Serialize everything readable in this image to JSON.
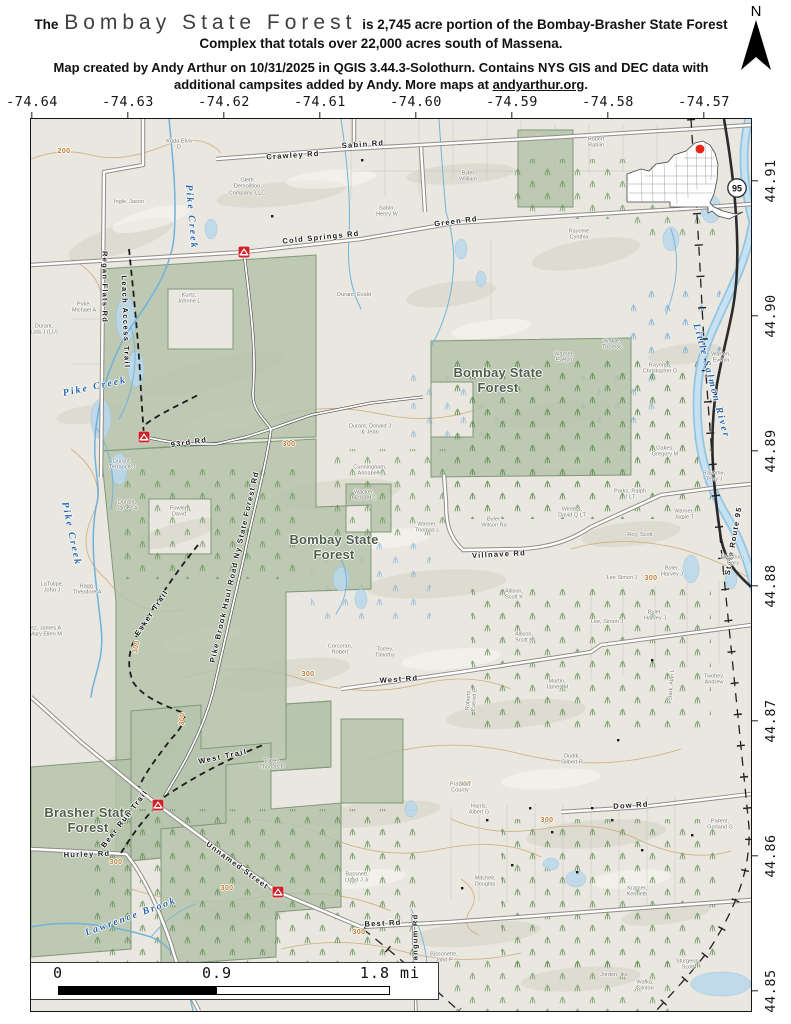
{
  "header": {
    "title_prefix": "The",
    "title_name": "Bombay State Forest",
    "title_rest": "is 2,745 acre portion of the Bombay-Brasher State Forest",
    "title_line2": "Complex that totals over 22,000 acres south of Massena.",
    "credit_line1": "Map created by Andy Arthur on 10/31/2025 in QGIS 3.44.3-Solothurn. Contains NYS GIS and DEC data with",
    "credit_line2_prefix": "additional campsites added by Andy. More maps at ",
    "credit_link": "andyarthur.org",
    "credit_suffix": ".",
    "north_label": "N"
  },
  "axes": {
    "longitudes": [
      "-74.64",
      "-74.63",
      "-74.62",
      "-74.61",
      "-74.60",
      "-74.59",
      "-74.58",
      "-74.57"
    ],
    "latitudes": [
      "44.91",
      "44.90",
      "44.89",
      "44.88",
      "44.87",
      "44.86",
      "44.85"
    ]
  },
  "scalebar": {
    "start": "0",
    "mid": "0.9",
    "end": "1.8 mi"
  },
  "map": {
    "inset": {
      "route_shield": "95"
    },
    "campsites": [
      {
        "x": 213,
        "y": 133
      },
      {
        "x": 113,
        "y": 318
      },
      {
        "x": 127,
        "y": 686
      },
      {
        "x": 247,
        "y": 773
      }
    ],
    "labels": [
      {
        "t": "Bombay State\nForest",
        "x": 467,
        "y": 262,
        "k": "forest"
      },
      {
        "t": "Bombay State\nForest",
        "x": 303,
        "y": 429,
        "k": "forest"
      },
      {
        "t": "Brasher State\nForest",
        "x": 57,
        "y": 702,
        "k": "forest"
      },
      {
        "t": "Pike Creek",
        "x": 160,
        "y": 98,
        "r": 85,
        "k": "water"
      },
      {
        "t": "Pike Creek",
        "x": 40,
        "y": 415,
        "r": 78,
        "k": "water"
      },
      {
        "t": "Pike Creek",
        "x": 64,
        "y": 268,
        "r": -12,
        "k": "water"
      },
      {
        "t": "Lawrence Brook",
        "x": 100,
        "y": 798,
        "r": -20,
        "k": "water"
      },
      {
        "t": "Little Salmon River",
        "x": 680,
        "y": 262,
        "r": 75,
        "k": "water"
      },
      {
        "t": "Crawley Rd",
        "x": 262,
        "y": 37,
        "r": -4,
        "k": "road"
      },
      {
        "t": "Sabin Rd",
        "x": 332,
        "y": 26,
        "r": -4,
        "k": "road"
      },
      {
        "t": "Cold Springs Rd",
        "x": 290,
        "y": 119,
        "r": -6,
        "k": "road"
      },
      {
        "t": "Green Rd",
        "x": 425,
        "y": 103,
        "r": -7,
        "k": "road"
      },
      {
        "t": "Regan Flats Rd",
        "x": 73,
        "y": 168,
        "r": 90,
        "k": "road"
      },
      {
        "t": "93rd Rd",
        "x": 158,
        "y": 324,
        "r": -8,
        "k": "road"
      },
      {
        "t": "Pike Brook Haul Road Ny State Forest Rd",
        "x": 204,
        "y": 448,
        "r": -77,
        "k": "road"
      },
      {
        "t": "Villnave Rd",
        "x": 468,
        "y": 436,
        "r": -3,
        "k": "road"
      },
      {
        "t": "West Rd",
        "x": 368,
        "y": 561,
        "r": -4,
        "k": "road"
      },
      {
        "t": "Hurley Rd",
        "x": 56,
        "y": 736,
        "r": -2,
        "k": "road"
      },
      {
        "t": "Unnamed Street",
        "x": 206,
        "y": 747,
        "r": 36,
        "k": "road"
      },
      {
        "t": "Best Rd",
        "x": 352,
        "y": 805,
        "r": -3,
        "k": "road"
      },
      {
        "t": "Dow Rd",
        "x": 600,
        "y": 687,
        "r": -4,
        "k": "road"
      },
      {
        "t": "Wangum Rd",
        "x": 385,
        "y": 822,
        "r": -90,
        "k": "road"
      },
      {
        "t": "State Route 95",
        "x": 703,
        "y": 422,
        "r": -80,
        "k": "road"
      },
      {
        "t": "Leach Access Trail",
        "x": 94,
        "y": 203,
        "r": 88,
        "k": "trail"
      },
      {
        "t": "Esker Trail",
        "x": 121,
        "y": 494,
        "r": -56,
        "k": "trail"
      },
      {
        "t": "West Trail",
        "x": 192,
        "y": 638,
        "r": -12,
        "k": "trail"
      },
      {
        "t": "Bear Run Trail",
        "x": 94,
        "y": 700,
        "r": -52,
        "k": "trail"
      },
      {
        "t": "200",
        "x": 33,
        "y": 33,
        "k": "contour"
      },
      {
        "t": "300",
        "x": 258,
        "y": 326,
        "k": "contour"
      },
      {
        "t": "300",
        "x": 106,
        "y": 528,
        "r": -80,
        "k": "contour"
      },
      {
        "t": "300",
        "x": 277,
        "y": 556,
        "k": "contour"
      },
      {
        "t": "300",
        "x": 85,
        "y": 744,
        "k": "contour"
      },
      {
        "t": "300",
        "x": 196,
        "y": 770,
        "k": "contour"
      },
      {
        "t": "300",
        "x": 434,
        "y": 666,
        "k": "contour"
      },
      {
        "t": "300",
        "x": 516,
        "y": 702,
        "k": "contour"
      },
      {
        "t": "300",
        "x": 620,
        "y": 460,
        "k": "contour"
      },
      {
        "t": "300",
        "x": 328,
        "y": 814,
        "k": "contour"
      },
      {
        "t": "300",
        "x": 152,
        "y": 600,
        "r": -85,
        "k": "contour"
      },
      {
        "t": "Kuda Elva\nD",
        "x": 148,
        "y": 26,
        "k": "parcel"
      },
      {
        "t": "Gleth\nDemolition\nCompany, LLC",
        "x": 216,
        "y": 68,
        "k": "parcel"
      },
      {
        "t": "Ingle, Jason",
        "x": 98,
        "y": 83,
        "k": "parcel"
      },
      {
        "t": "Byler\nWilliam",
        "x": 437,
        "y": 58,
        "k": "parcel"
      },
      {
        "t": "Robert\nRablin",
        "x": 565,
        "y": 24,
        "k": "parcel"
      },
      {
        "t": "Sabin,\nHenry W",
        "x": 356,
        "y": 93,
        "k": "parcel"
      },
      {
        "t": "Rayome\nCynthia",
        "x": 548,
        "y": 116,
        "k": "parcel"
      },
      {
        "t": "Pyke,\nMichael A",
        "x": 53,
        "y": 189,
        "k": "parcel"
      },
      {
        "t": "Kurtz,\nJohnne L",
        "x": 158,
        "y": 180,
        "k": "parcel"
      },
      {
        "t": "Durant, Evald",
        "x": 323,
        "y": 176,
        "k": "parcel"
      },
      {
        "t": "Durant,\nLida J (LU)",
        "x": 13,
        "y": 211,
        "k": "parcel"
      },
      {
        "t": "Wakle,\nThomas",
        "x": 581,
        "y": 226,
        "k": "parcel"
      },
      {
        "t": "Warren,\nEvelyn",
        "x": 690,
        "y": 239,
        "k": "parcel"
      },
      {
        "t": "Warner,\nEvelyn",
        "x": 533,
        "y": 239,
        "k": "parcel"
      },
      {
        "t": "Rayome,\nChristopher O",
        "x": 629,
        "y": 250,
        "k": "parcel"
      },
      {
        "t": "Durant,\nTerrance J",
        "x": 91,
        "y": 346,
        "k": "parcel"
      },
      {
        "t": "Durant,\nJames A",
        "x": 96,
        "y": 387,
        "k": "parcel"
      },
      {
        "t": "Fowler,\nDavid",
        "x": 148,
        "y": 393,
        "k": "parcel"
      },
      {
        "t": "Durant, Donald J\n& Jean",
        "x": 339,
        "y": 311,
        "k": "parcel"
      },
      {
        "t": "Cunningham,\nAnnabelle",
        "x": 339,
        "y": 352,
        "k": "parcel"
      },
      {
        "t": "Wacker,\nMichael C",
        "x": 333,
        "y": 377,
        "k": "parcel"
      },
      {
        "t": "LaTulipe,\nJohn J",
        "x": 21,
        "y": 469,
        "k": "parcel"
      },
      {
        "t": "Hagg,\nTheodore A",
        "x": 56,
        "y": 471,
        "k": "parcel"
      },
      {
        "t": "Getz, James A\n& Mary Ellen M",
        "x": 12,
        "y": 513,
        "k": "parcel"
      },
      {
        "t": "Oakes,\nGregory M",
        "x": 634,
        "y": 333,
        "k": "parcel"
      },
      {
        "t": "Rayome,\nTerry J",
        "x": 683,
        "y": 358,
        "k": "parcel"
      },
      {
        "t": "Warner,\nJamie T",
        "x": 653,
        "y": 396,
        "k": "parcel"
      },
      {
        "t": "Parks, Ralph\nJ LT",
        "x": 599,
        "y": 376,
        "k": "parcel"
      },
      {
        "t": "Winters,\nDavid Q LT",
        "x": 541,
        "y": 394,
        "k": "parcel"
      },
      {
        "t": "Byler,\nWilson Ru",
        "x": 463,
        "y": 404,
        "k": "parcel"
      },
      {
        "t": "Warner,\nThomas L",
        "x": 396,
        "y": 409,
        "k": "parcel"
      },
      {
        "t": "Roy, Scott",
        "x": 609,
        "y": 416,
        "k": "parcel"
      },
      {
        "t": "Monahan,\nGary",
        "x": 702,
        "y": 442,
        "k": "parcel"
      },
      {
        "t": "Lee Simon J",
        "x": 591,
        "y": 459,
        "k": "parcel"
      },
      {
        "t": "Byler,\nHarvey J",
        "x": 641,
        "y": 453,
        "k": "parcel"
      },
      {
        "t": "Lee, Simon J",
        "x": 576,
        "y": 503,
        "k": "parcel"
      },
      {
        "t": "Byler,\nHarvey J",
        "x": 624,
        "y": 497,
        "k": "parcel"
      },
      {
        "t": "Allison,\nScott K",
        "x": 483,
        "y": 476,
        "k": "parcel"
      },
      {
        "t": "Corcoran,\nRobert",
        "x": 309,
        "y": 531,
        "k": "parcel"
      },
      {
        "t": "Torrey,\nTimothy",
        "x": 354,
        "y": 534,
        "k": "parcel"
      },
      {
        "t": "Allison,\nScott K",
        "x": 493,
        "y": 519,
        "k": "parcel"
      },
      {
        "t": "Torrey,\nThomas P",
        "x": 241,
        "y": 646,
        "k": "parcel"
      },
      {
        "t": "Martin,\nJames M",
        "x": 526,
        "y": 566,
        "k": "parcel"
      },
      {
        "t": "Roberts,\nEverett L",
        "x": 441,
        "y": 581,
        "r": -85,
        "k": "parcel"
      },
      {
        "t": "Dudik,\nGilbert R",
        "x": 541,
        "y": 641,
        "k": "parcel"
      },
      {
        "t": "Harris,\nAlbert G",
        "x": 448,
        "y": 691,
        "k": "parcel"
      },
      {
        "t": "Franklin\nCounty",
        "x": 429,
        "y": 669,
        "k": "parcel"
      },
      {
        "t": "Stark, Alan L",
        "x": 641,
        "y": 566,
        "r": -85,
        "k": "parcel"
      },
      {
        "t": "Twohey,\nAndrew",
        "x": 683,
        "y": 561,
        "k": "parcel"
      },
      {
        "t": "Mitchell,\nDouglas",
        "x": 454,
        "y": 763,
        "k": "parcel"
      },
      {
        "t": "Kramer,\nKenneth",
        "x": 606,
        "y": 773,
        "k": "parcel"
      },
      {
        "t": "Parent,\nGorland G",
        "x": 689,
        "y": 706,
        "k": "parcel"
      },
      {
        "t": "Sturgeon,\nScott",
        "x": 657,
        "y": 846,
        "k": "parcel"
      },
      {
        "t": "Wafka,\nClinton",
        "x": 614,
        "y": 867,
        "k": "parcel"
      },
      {
        "t": "Jorden, Ike",
        "x": 583,
        "y": 856,
        "k": "parcel"
      },
      {
        "t": "Bissonette,\nJohn P",
        "x": 413,
        "y": 839,
        "k": "parcel"
      },
      {
        "t": "Bassnett,\nLloyd J Jr",
        "x": 326,
        "y": 759,
        "k": "parcel"
      }
    ]
  }
}
